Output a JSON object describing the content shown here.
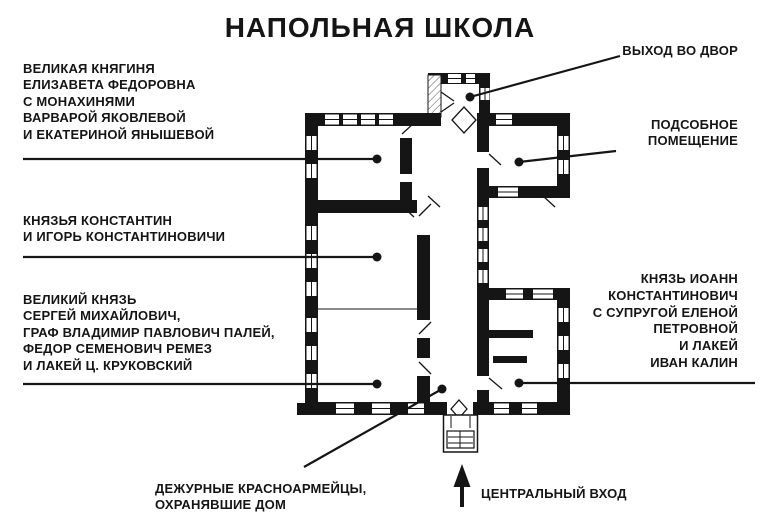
{
  "title": "НАПОЛЬНАЯ ШКОЛА",
  "callouts": {
    "elizaveta": {
      "lines": [
        "ВЕЛИКАЯ КНЯГИНЯ",
        "ЕЛИЗАВЕТА ФЕДОРОВНА",
        "С МОНАХИНЯМИ",
        "ВАРВАРОЙ ЯКОВЛЕВОЙ",
        "И ЕКАТЕРИНОЙ ЯНЫШЕВОЙ"
      ]
    },
    "exit_yard": {
      "label": "ВЫХОД ВО ДВОР"
    },
    "utility": {
      "lines": [
        "ПОДСОБНОЕ",
        "ПОМЕЩЕНИЕ"
      ]
    },
    "konstantin_igor": {
      "lines": [
        "КНЯЗЬЯ КОНСТАНТИН",
        "И ИГОРЬ КОНСТАНТИНОВИЧИ"
      ]
    },
    "sergey": {
      "lines": [
        "ВЕЛИКИЙ КНЯЗЬ",
        "СЕРГЕЙ МИХАЙЛОВИЧ,",
        "ГРАФ ВЛАДИМИР ПАВЛОВИЧ ПАЛЕЙ,",
        "ФЕДОР СЕМЕНОВИЧ РЕМЕЗ",
        "И ЛАКЕЙ Ц. КРУКОВСКИЙ"
      ]
    },
    "ioann": {
      "lines": [
        "КНЯЗЬ ИОАНН",
        "КОНСТАНТИНОВИЧ",
        "С СУПРУГОЙ ЕЛЕНОЙ",
        "ПЕТРОВНОЙ",
        "И ЛАКЕЙ",
        "ИВАН КАЛИН"
      ]
    },
    "guards": {
      "lines": [
        "ДЕЖУРНЫЕ КРАСНОАРМЕЙЦЫ,",
        "ОХРАНЯВШИЕ ДОМ"
      ]
    },
    "central_entrance": {
      "label": "ЦЕНТРАЛЬНЫЙ ВХОД"
    }
  },
  "colors": {
    "ink": "#151515",
    "background": "#ffffff",
    "partition_gray": "#8a8a8a"
  }
}
